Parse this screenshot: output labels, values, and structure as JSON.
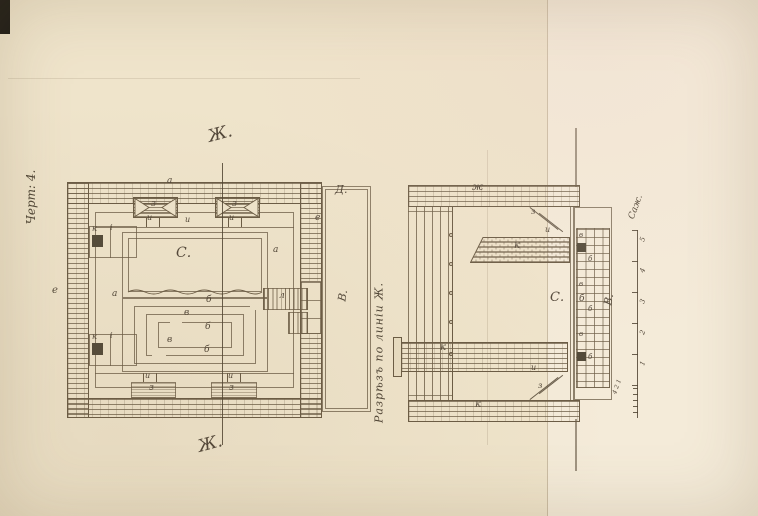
{
  "colors": {
    "paper": "#efe4cb",
    "paper_right": "#f4ebd9",
    "ink": "#6b5c45",
    "handwriting": "#53483a"
  },
  "page": {
    "figure_label": "Черт: 4.",
    "section_caption": "Разрѣзъ по линіи Ж."
  },
  "plan": {
    "labels": [
      {
        "t": "Ж.",
        "x": 208,
        "y": 126,
        "s": 17,
        "r": -15
      },
      {
        "t": "Ж.",
        "x": 198,
        "y": 436,
        "s": 17,
        "r": -15
      },
      {
        "t": "а",
        "x": 167,
        "y": 177,
        "s": 9
      },
      {
        "t": "з",
        "x": 151,
        "y": 200,
        "s": 9
      },
      {
        "t": "з",
        "x": 232,
        "y": 200,
        "s": 9
      },
      {
        "t": "и",
        "x": 147,
        "y": 214,
        "s": 8
      },
      {
        "t": "и",
        "x": 185,
        "y": 216,
        "s": 8
      },
      {
        "t": "и",
        "x": 229,
        "y": 214,
        "s": 8
      },
      {
        "t": "С.",
        "x": 176,
        "y": 246,
        "s": 14
      },
      {
        "t": "а",
        "x": 112,
        "y": 290,
        "s": 9
      },
      {
        "t": "а",
        "x": 273,
        "y": 246,
        "s": 9
      },
      {
        "t": "к",
        "x": 92,
        "y": 225,
        "s": 8
      },
      {
        "t": "i",
        "x": 110,
        "y": 224,
        "s": 8
      },
      {
        "t": "к",
        "x": 92,
        "y": 333,
        "s": 8
      },
      {
        "t": "i",
        "x": 110,
        "y": 332,
        "s": 8
      },
      {
        "t": "е",
        "x": 52,
        "y": 286,
        "s": 10
      },
      {
        "t": "л",
        "x": 279,
        "y": 292,
        "s": 9
      },
      {
        "t": "б",
        "x": 206,
        "y": 296,
        "s": 9
      },
      {
        "t": "в",
        "x": 184,
        "y": 309,
        "s": 9
      },
      {
        "t": "б",
        "x": 205,
        "y": 323,
        "s": 9
      },
      {
        "t": "в",
        "x": 167,
        "y": 336,
        "s": 9
      },
      {
        "t": "б",
        "x": 204,
        "y": 346,
        "s": 9
      },
      {
        "t": "и",
        "x": 145,
        "y": 372,
        "s": 8
      },
      {
        "t": "и",
        "x": 228,
        "y": 372,
        "s": 8
      },
      {
        "t": "з",
        "x": 149,
        "y": 384,
        "s": 9
      },
      {
        "t": "з",
        "x": 229,
        "y": 384,
        "s": 9
      },
      {
        "t": "Д.",
        "x": 335,
        "y": 184,
        "s": 11
      },
      {
        "t": "е",
        "x": 315,
        "y": 214,
        "s": 9
      },
      {
        "t": "В.",
        "x": 337,
        "y": 290,
        "s": 11,
        "r": -80
      }
    ]
  },
  "section": {
    "labels": [
      {
        "t": "ж",
        "x": 472,
        "y": 183,
        "s": 10
      },
      {
        "t": "з",
        "x": 531,
        "y": 208,
        "s": 8
      },
      {
        "t": "и",
        "x": 545,
        "y": 226,
        "s": 8
      },
      {
        "t": "к",
        "x": 514,
        "y": 241,
        "s": 10
      },
      {
        "t": "С.",
        "x": 550,
        "y": 291,
        "s": 13
      },
      {
        "t": "б",
        "x": 579,
        "y": 295,
        "s": 9
      },
      {
        "t": "к",
        "x": 440,
        "y": 343,
        "s": 10
      },
      {
        "t": "и",
        "x": 531,
        "y": 364,
        "s": 8
      },
      {
        "t": "з",
        "x": 538,
        "y": 382,
        "s": 8
      },
      {
        "t": "к",
        "x": 475,
        "y": 400,
        "s": 10
      },
      {
        "t": "в",
        "x": 579,
        "y": 232,
        "s": 7
      },
      {
        "t": "б",
        "x": 588,
        "y": 256,
        "s": 7
      },
      {
        "t": "в",
        "x": 579,
        "y": 281,
        "s": 7
      },
      {
        "t": "б",
        "x": 588,
        "y": 306,
        "s": 7
      },
      {
        "t": "в",
        "x": 579,
        "y": 331,
        "s": 7
      },
      {
        "t": "б",
        "x": 588,
        "y": 354,
        "s": 7
      },
      {
        "t": "В.",
        "x": 603,
        "y": 294,
        "s": 11,
        "r": -80
      }
    ]
  },
  "scale": {
    "unit_label": "Саж.",
    "labels": [
      {
        "t": "5",
        "x": 641,
        "y": 236,
        "s": 7,
        "r": -70
      },
      {
        "t": "4",
        "x": 641,
        "y": 267,
        "s": 7,
        "r": -70
      },
      {
        "t": "3",
        "x": 641,
        "y": 298,
        "s": 7,
        "r": -70
      },
      {
        "t": "2",
        "x": 641,
        "y": 329,
        "s": 7,
        "r": -70
      },
      {
        "t": "1",
        "x": 641,
        "y": 360,
        "s": 7,
        "r": -70
      },
      {
        "t": "4 2 1",
        "x": 610,
        "y": 384,
        "s": 6,
        "r": -70
      }
    ]
  }
}
